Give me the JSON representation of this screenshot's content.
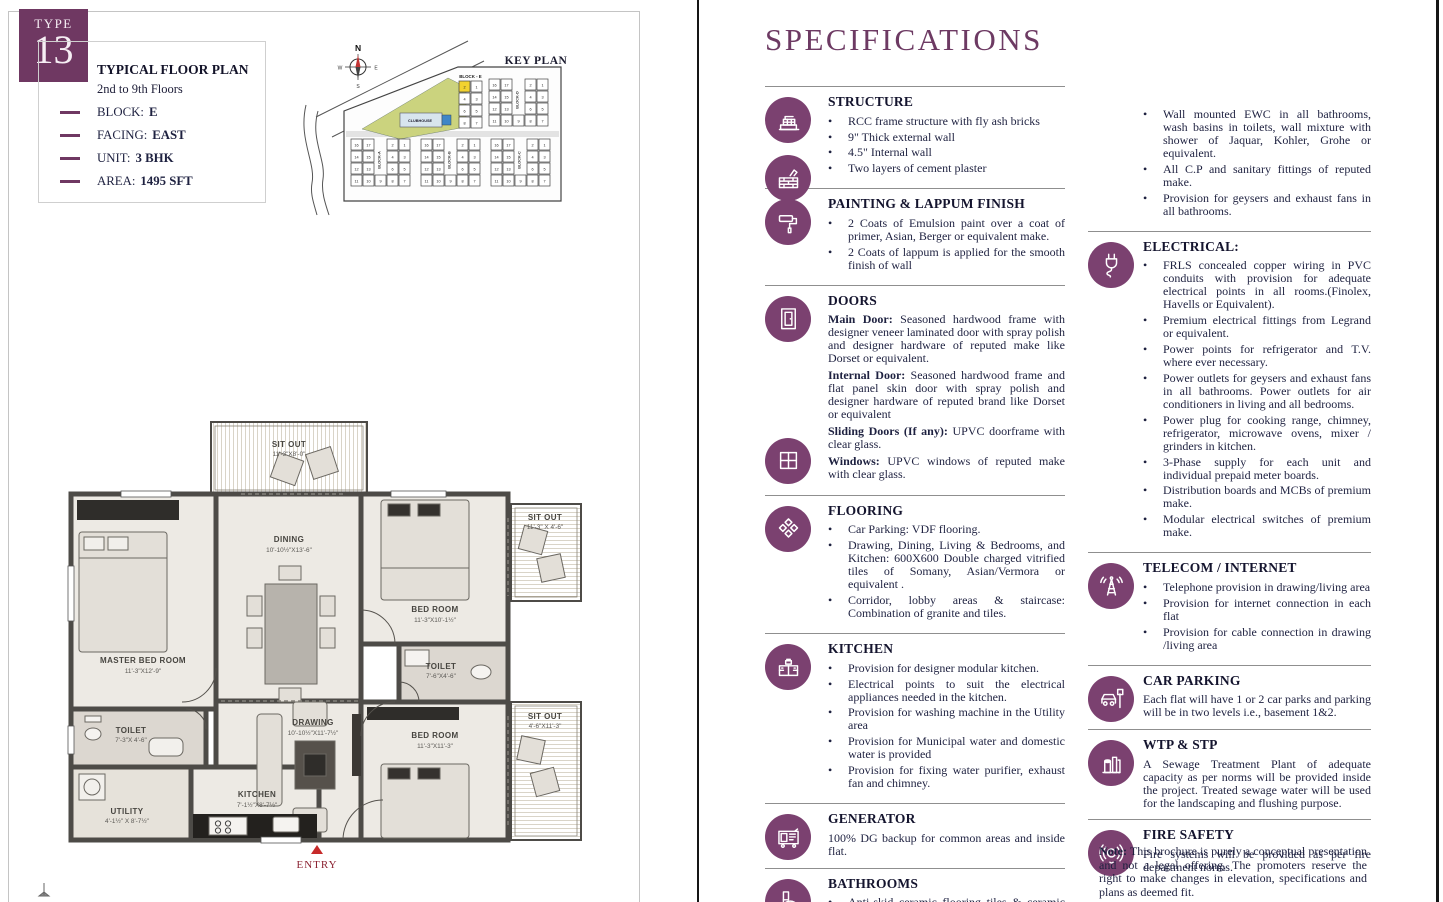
{
  "page": {
    "type_label": "TYPE",
    "type_number": "13",
    "info": {
      "title": "TYPICAL FLOOR PLAN",
      "subtitle": "2nd to 9th Floors",
      "items": [
        {
          "label": "BLOCK:",
          "value": "E"
        },
        {
          "label": "FACING:",
          "value": "EAST"
        },
        {
          "label": "UNIT:",
          "value": "3 BHK"
        },
        {
          "label": "AREA:",
          "value": "1495 SFT"
        }
      ]
    },
    "key_plan": {
      "title": "KEY PLAN",
      "compass": {
        "n": "N",
        "e": "E",
        "s": "S",
        "w": "W"
      },
      "clubhouse": "CLUBHOUSE",
      "blocks": [
        "BLOCK-A",
        "BLOCK-B",
        "BLOCK-C",
        "BLOCK-D",
        "BLOCK - E"
      ],
      "highlighted_unit": "2",
      "e_rows": [
        [
          "2",
          "1"
        ],
        [
          "4",
          "3"
        ],
        [
          "6",
          "5"
        ],
        [
          "8",
          "7"
        ]
      ],
      "cluster_rows": [
        [
          "16",
          "17",
          "2",
          "1"
        ],
        [
          "14",
          "15",
          "4",
          "3"
        ],
        [
          "12",
          "13",
          "6",
          "5"
        ],
        [
          "11",
          "10",
          "9",
          "8",
          "7"
        ]
      ]
    },
    "floor_plan": {
      "entry_label": "ENTRY",
      "rooms": [
        {
          "name": "SIT OUT",
          "dims": "11'-3\"X8'-0\""
        },
        {
          "name": "DINING",
          "dims": "10'-10½\"X13'-6\""
        },
        {
          "name": "MASTER BED ROOM",
          "dims": "11'-3\"X12'-9\""
        },
        {
          "name": "BED ROOM",
          "dims": "11'-3\"X10'-1½\""
        },
        {
          "name": "SIT OUT",
          "dims": "11'-3\" X 4'-6\""
        },
        {
          "name": "TOILET",
          "dims": "7'-6\"X4'-6\""
        },
        {
          "name": "BED ROOM",
          "dims": "11'-3\"X11'-3\""
        },
        {
          "name": "SIT OUT",
          "dims": "4'-6\"X11'-3\""
        },
        {
          "name": "TOILET",
          "dims": "7'-3\"X 4'-6\""
        },
        {
          "name": "KITCHEN",
          "dims": "7'-1½\"X8'-7½\""
        },
        {
          "name": "UTILITY",
          "dims": "4'-1½\" X 8'-7½\""
        },
        {
          "name": "DRAWING",
          "dims": "10'-10½\"X11'-7½\""
        }
      ]
    }
  },
  "specs": {
    "title": "SPECIFICATIONS",
    "left_sections": [
      {
        "heading": "STRUCTURE",
        "icons": [
          "building-icon",
          "bricks-icon"
        ],
        "bullets": [
          "RCC frame structure with fly ash bricks",
          "9\" Thick external wall",
          "4.5\" Internal wall",
          "Two layers of cement plaster"
        ]
      },
      {
        "heading": "PAINTING & LAPPUM FINISH",
        "icons": [
          "paint-roller-icon"
        ],
        "bullets": [
          "2 Coats of Emulsion paint over a coat of primer, Asian, Berger or equivalent make.",
          "2 Coats of lappum is applied for the smooth finish of wall"
        ]
      },
      {
        "heading": "DOORS",
        "icons": [
          "door-icon",
          "window-icon"
        ],
        "paragraphs": [
          {
            "b": "Main Door:",
            "t": " Seasoned hardwood frame with designer veneer laminated door with spray polish and designer hardware of reputed make like Dorset or equivalent."
          },
          {
            "b": "Internal Door:",
            "t": " Seasoned hardwood frame and flat panel skin door with spray polish and designer hardware of reputed brand like Dorset or equivalent"
          },
          {
            "b": "Sliding Doors (If any):",
            "t": " UPVC doorframe with clear glass."
          },
          {
            "b": "Windows:",
            "t": " UPVC windows of reputed make with clear glass."
          }
        ]
      },
      {
        "heading": "FLOORING",
        "icons": [
          "tiles-icon"
        ],
        "bullets": [
          "Car Parking: VDF flooring.",
          "Drawing, Dining, Living & Bedrooms, and Kitchen: 600X600 Double charged vitrified tiles of Somany, Asian/Vermora or equivalent .",
          "Corridor, lobby areas & staircase: Combination of granite and tiles."
        ]
      },
      {
        "heading": "KITCHEN",
        "icons": [
          "kitchen-icon"
        ],
        "bullets": [
          "Provision for designer modular kitchen.",
          "Electrical points to suit the electrical appliances needed in the kitchen.",
          "Provision for washing machine in the Utility area",
          "Provision for Municipal water and domestic water is provided",
          "Provision for fixing water purifier, exhaust fan and chimney."
        ]
      },
      {
        "heading": "GENERATOR",
        "icons": [
          "generator-icon"
        ],
        "text": "100% DG backup for common areas and inside flat."
      },
      {
        "heading": "BATHROOMS",
        "icons": [
          "toilet-icon"
        ],
        "bullets": [
          "Anti-skid ceramic flooring tiles & ceramic tiles for dadoing."
        ]
      }
    ],
    "right_sections": [
      {
        "heading": null,
        "icons": [],
        "bullets": [
          "Wall mounted EWC in all bathrooms, wash basins in toilets, wall mixture with shower of Jaquar, Kohler, Grohe or equivalent.",
          "All C.P and sanitary fittings of reputed make.",
          "Provision for geysers and exhaust fans in all bathrooms."
        ]
      },
      {
        "heading": "ELECTRICAL:",
        "icons": [
          "plug-icon"
        ],
        "bullets": [
          "FRLS concealed copper wiring in PVC conduits with provision for adequate electrical points in all rooms.(Finolex, Havells or Equivalent).",
          "Premium electrical fittings from Legrand or equivalent.",
          "Power points for refrigerator and T.V. where ever necessary.",
          "Power outlets for geysers and exhaust fans in all bathrooms. Power outlets for air conditioners in living and all bedrooms.",
          "Power plug for cooking range, chimney, refrigerator, microwave ovens, mixer / grinders in kitchen.",
          "3-Phase supply for each unit and individual prepaid meter boards.",
          "Distribution boards and MCBs of premium make.",
          "Modular electrical switches of premium make."
        ]
      },
      {
        "heading": "TELECOM / INTERNET",
        "icons": [
          "antenna-icon"
        ],
        "bullets": [
          "Telephone provision in drawing/living area",
          "Provision for internet connection in each flat",
          "Provision for cable connection in drawing /living area"
        ]
      },
      {
        "heading": "CAR PARKING",
        "icons": [
          "car-icon"
        ],
        "text": "Each flat will have 1 or 2 car parks and parking will be in two levels i.e., basement 1&2."
      },
      {
        "heading": "WTP & STP",
        "icons": [
          "wtp-icon"
        ],
        "text": "A Sewage Treatment Plant of adequate capacity as per norms will be provided inside the project. Treated sewage water will be used for the landscaping and flushing purpose."
      },
      {
        "heading": "FIRE SAFETY",
        "icons": [
          "fire-alarm-icon"
        ],
        "text": "Fire systems will be provided as per fire department norms."
      }
    ],
    "note_label": "Note:",
    "note_text": "This brochure is purely a conceptual presentation and not a legal offering.  The promoters reserve the right to make changes in elevation, specifications and plans as deemed fit."
  },
  "colors": {
    "accent_purple": "#6f3862",
    "icon_circle_purple": "#7b4170",
    "title_purple": "#6d3a63",
    "highlight_yellow": "#f2d230",
    "entry_red": "#c62a2a",
    "text_dark": "#1e2140"
  }
}
